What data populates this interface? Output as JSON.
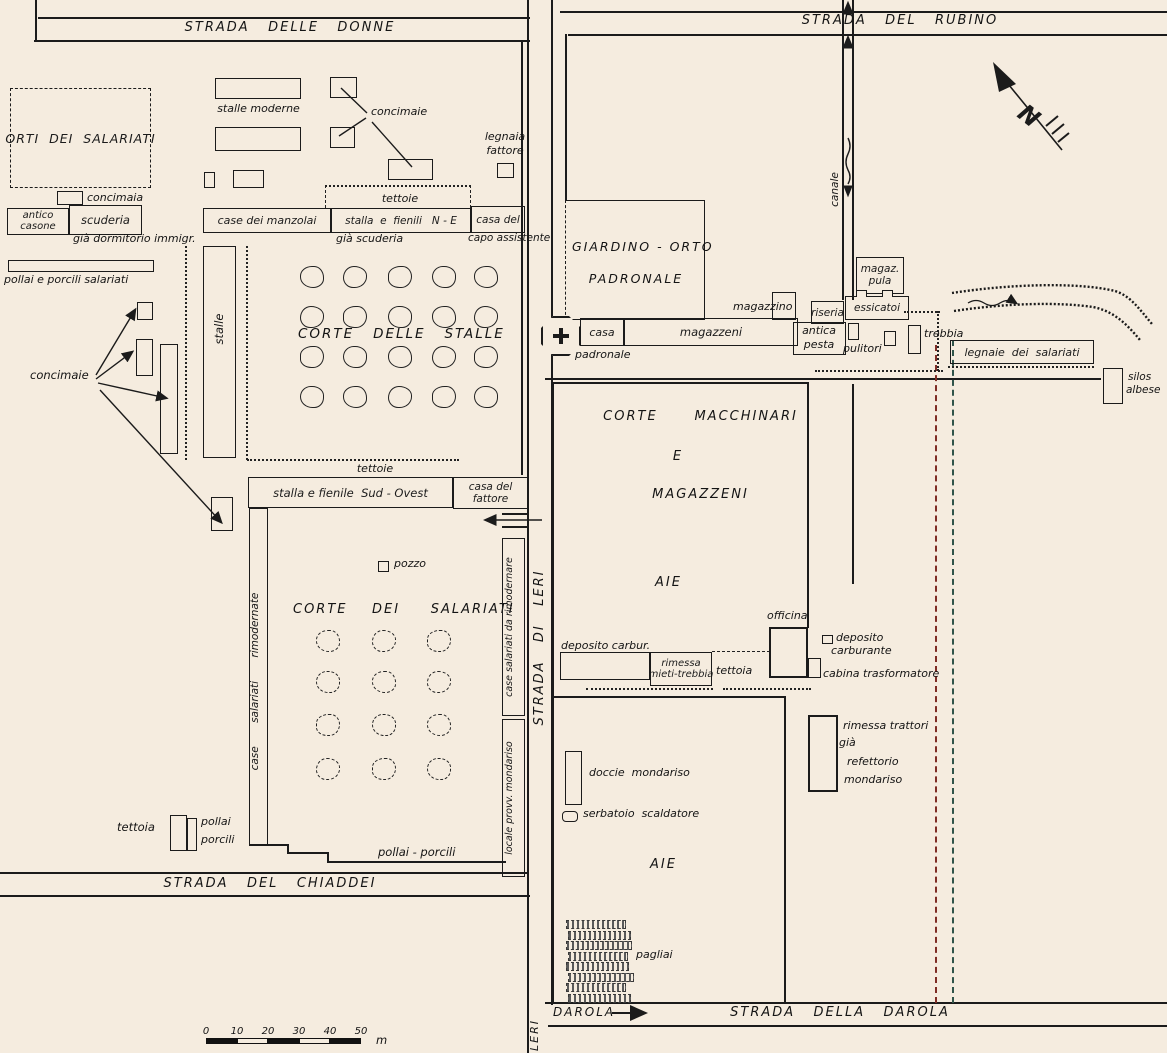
{
  "roads": {
    "donne": "STRADA   DELLE   DONNE",
    "rubino": "STRADA   DEL   RUBINO",
    "leri": "STRADA   DI   LERI",
    "chiaddei": "STRADA   DEL   CHIADDEI",
    "darola": "STRADA   DELLA   DAROLA",
    "darola_dir": "DAROLA",
    "leri_dir": "LERI",
    "canale": "canale"
  },
  "compass": {
    "north": "N"
  },
  "courts": {
    "corte_stalle": "CORTE   DELLE   STALLE",
    "corte_salariati": "CORTE    DEI     SALARIATI",
    "corte_macch_1": "CORTE      MACCHINARI",
    "corte_macch_2": "E",
    "corte_macch_3": "MAGAZZENI",
    "aie_upper": "AIE",
    "aie_lower": "AIE"
  },
  "labels": {
    "orti": "ORTI  DEI  SALARIATI",
    "stalle_moderne": "stalle moderne",
    "concimaie_ne": "concimaie",
    "legnaia_1": "legnaia",
    "legnaia_2": "fattore",
    "concimaia_legend": "concimaia",
    "antico_1": "antico",
    "antico_2": "casone",
    "scuderia": "scuderia",
    "gia_dormitorio": "già dormitorio immigr.",
    "pollai_salariati": "pollai e porcili salariati",
    "concimaie_w": "concimaie",
    "stalle_v": "stalle",
    "case_manzolai": "case dei manzolai",
    "tettoie_n": "tettoie",
    "stalla_ne": "stalla  e  fienili   N - E",
    "gia_scuderia": "già scuderia",
    "casa_capo_1": "casa del",
    "casa_capo_2": "capo assistente",
    "tettoie_s": "tettoie",
    "stalla_so": "stalla e fienile  Sud - Ovest",
    "casa_fattore_1": "casa del",
    "casa_fattore_2": "fattore",
    "pozzo": "pozzo",
    "case_rimodernate": "case       salariati       rimodernate",
    "case_da_rimodernare": "case salariati da rimodernare",
    "locale_provv": "locale provv. mondariso",
    "pollai_porcili_s": "pollai - porcili",
    "tettoia_sw": "tettoia",
    "pollai_sw": "pollai",
    "porcili_sw": "porcili",
    "giardino_1": "GIARDINO - ORTO",
    "giardino_2": "PADRONALE",
    "casa_padronale_1": "casa",
    "casa_padronale_2": "padronale",
    "magazzeni": "magazzeni",
    "magazzino": "magazzino",
    "riseria": "riseria",
    "antica_pesta_1": "antica",
    "antica_pesta_2": "pesta",
    "magaz_pula_1": "magaz.",
    "magaz_pula_2": "pula",
    "essicatoi": "essicatoi",
    "pulitori": "pulitori",
    "trebbia": "trebbia",
    "legnaie_salariati": "legnaie  dei  salariati",
    "silos_1": "silos",
    "silos_2": "albese",
    "deposito_carbur": "deposito carbur.",
    "rimessa_1": "rimessa",
    "rimessa_2": "mieti-trebbia",
    "tettoia_e": "tettoia",
    "officina": "officina",
    "deposito_carburante_1": "deposito",
    "deposito_carburante_2": "carburante",
    "cabina": "cabina trasformatore",
    "rimessa_trattori_1": "rimessa trattori",
    "rimessa_trattori_2": "già",
    "rimessa_trattori_3": "refettorio",
    "rimessa_trattori_4": "mondariso",
    "doccie": "doccie  mondariso",
    "serbatoio": "serbatoio  scaldatore",
    "pagliai": "pagliai"
  },
  "scalebar": {
    "ticks": [
      "0",
      "10",
      "20",
      "30",
      "40",
      "50"
    ],
    "unit": "m"
  }
}
